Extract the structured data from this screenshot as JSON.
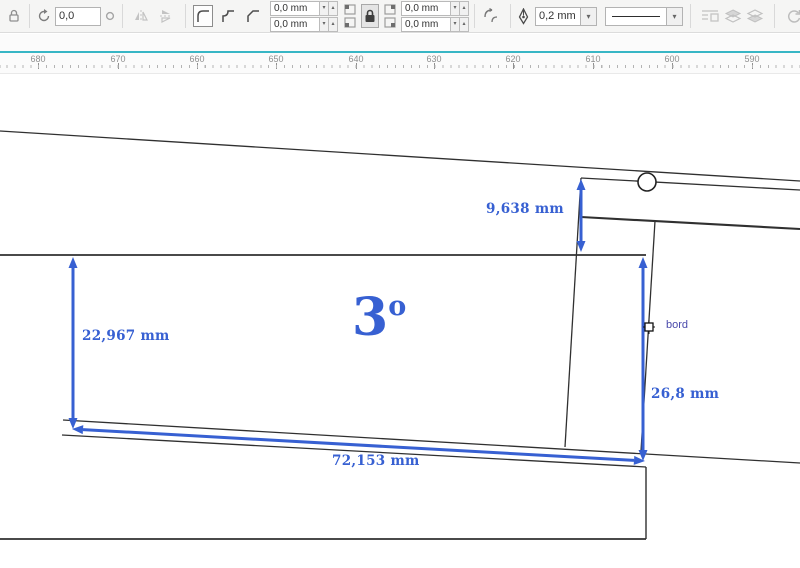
{
  "property_bar": {
    "rotation_angle": {
      "value": "0,0"
    },
    "corner_radius": {
      "top_left": "0,0 mm",
      "bottom_left": "0,0 mm",
      "top_right": "0,0 mm",
      "bottom_right": "0,0 mm"
    },
    "outline_width": {
      "value": "0,2 mm"
    },
    "glyphs": {
      "spinner_down": "▾",
      "spinner_up": "▴",
      "dropdown_arrow": "▾"
    }
  },
  "ruler": {
    "unit_labels": [
      "680",
      "670",
      "660",
      "650",
      "640",
      "630",
      "620",
      "610",
      "600",
      "590"
    ]
  },
  "drawing": {
    "dimensions": {
      "gap_top": "9,638 mm",
      "height_left": "22,967 mm",
      "length_bottom": "72,153 mm",
      "height_right": "26,8 mm"
    },
    "angle": {
      "value": "3",
      "unit": "o"
    },
    "edge_label": "bord"
  },
  "colors": {
    "dimension_blue": "#3760d2",
    "edge_label_indigo": "#4949ab",
    "line_black": "#303030",
    "ruler_accent_teal": "#38b6c5",
    "toolbar_bg": "#f5f5f4"
  }
}
